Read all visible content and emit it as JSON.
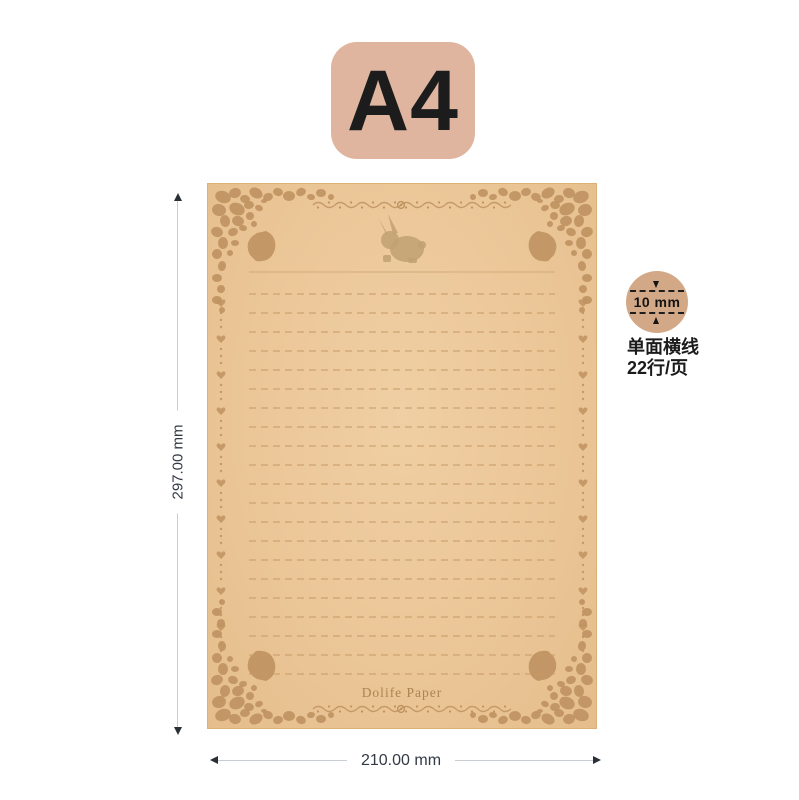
{
  "product": {
    "size_badge": "A4",
    "brand": "Dolife Paper"
  },
  "paper": {
    "lines_count": 22,
    "ruling": "horizontal-dashed-lines",
    "rabbit_icon": "rabbit-silhouette"
  },
  "dimensions": {
    "height_label": "297.00 mm",
    "width_label": "210.00 mm"
  },
  "spec": {
    "line_spacing_label": "10 mm",
    "text_line1": "单面横线",
    "text_line2": "22行/页"
  },
  "icons": {
    "rabbit": "rabbit-silhouette",
    "spacing_arrows": "arrow-down-icon / arrow-up-icon",
    "dimension_arrows": "arrow-up-icon / arrow-down-icon / arrow-left-icon / arrow-right-icon"
  },
  "colors": {
    "badge_bg": "#dfb5a0",
    "paper_bg": "#ebc697",
    "ornament": "#bf9260",
    "rule_line": "#c59a66",
    "rabbit": "#c2a172",
    "brand_text": "#aa8551",
    "spec_circle_bg": "#d2a887",
    "dim_line": "#c9ced4",
    "dimension_text": "#333a44"
  }
}
